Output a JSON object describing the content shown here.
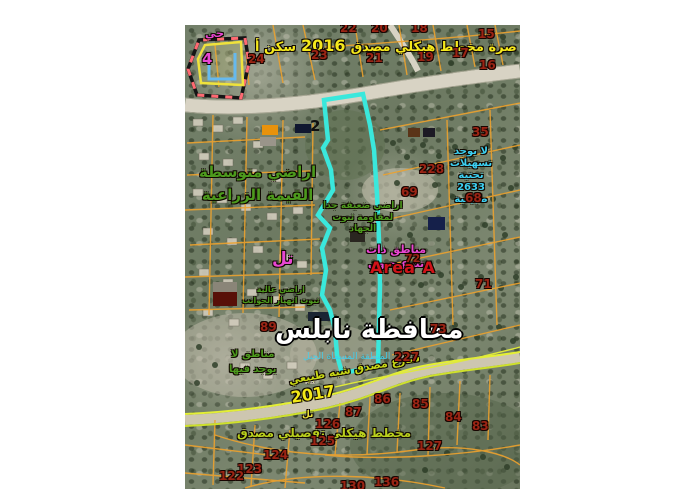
{
  "map": {
    "type": "satellite-cadastral-plan",
    "title_part1": "سكن أ",
    "title_year": "2016",
    "title_part2": "صرة مخطط هيكلي مصدق",
    "district_label": "حي",
    "district_number": "4",
    "legend_number": "2",
    "land_medium": {
      "line1": "اراضي متوسطة",
      "line2": "القيمة الزراعية"
    },
    "land_weak": {
      "line1": "اراضي ضعيفة جدا",
      "line2": "لمقاومة ثبوت",
      "line3": "الجهاد"
    },
    "no_facilities": {
      "line1": "لا يوجد",
      "line2": "تسهيلات",
      "line3": "تحتية",
      "number": "2633",
      "line5": "طبيعية"
    },
    "biodiversity": {
      "line1": "مناطق ذات",
      "line2": "تنوع حيوي"
    },
    "area_a": "Area A",
    "tell_label": "تل",
    "high_lands": {
      "line1": "اراضي عالية",
      "line2": "ثبوت انهيار الجوانب"
    },
    "no_zones": {
      "line1": "مناطق لا",
      "line2": "يوجد فيها"
    },
    "governorate": "محافظة نابلس",
    "subcaption": "المنطقة المسماة الجبل",
    "road_label": "شارع مصدق شبه طبيعي",
    "year_2017": "2017",
    "tell_small": "تل",
    "detailed_plan": "مخطط هيكلي تفصيلي مصدق"
  },
  "parcels": {
    "p22": "22",
    "p20": "20",
    "p18": "18",
    "p15": "15",
    "p24": "24",
    "p23": "23",
    "p21": "21",
    "p19": "19",
    "p17": "17",
    "p16": "16",
    "p35": "35",
    "p228": "228",
    "p69": "69",
    "p68": "68",
    "p72": "72",
    "p71": "71",
    "p89": "89",
    "p73": "73",
    "p227": "227",
    "p86": "86",
    "p87": "87",
    "p85": "85",
    "p84": "84",
    "p83": "83",
    "p126": "126",
    "p125": "125",
    "p127": "127",
    "p136": "136",
    "p124": "124",
    "p123": "123",
    "p122": "122",
    "p130": "130"
  },
  "colors": {
    "selection_polygon": "#3ae8dc",
    "parcel_lines": "#eda22e",
    "parcel_numbers": "#9b2414",
    "plan_title": "#f4e81c",
    "agri_text": "#4c9a1d",
    "info_text_cyan": "#3cd0f2",
    "biodiversity_text": "#e846d2",
    "area_a_text": "#d01218",
    "road_edge": "#e4ef35"
  }
}
